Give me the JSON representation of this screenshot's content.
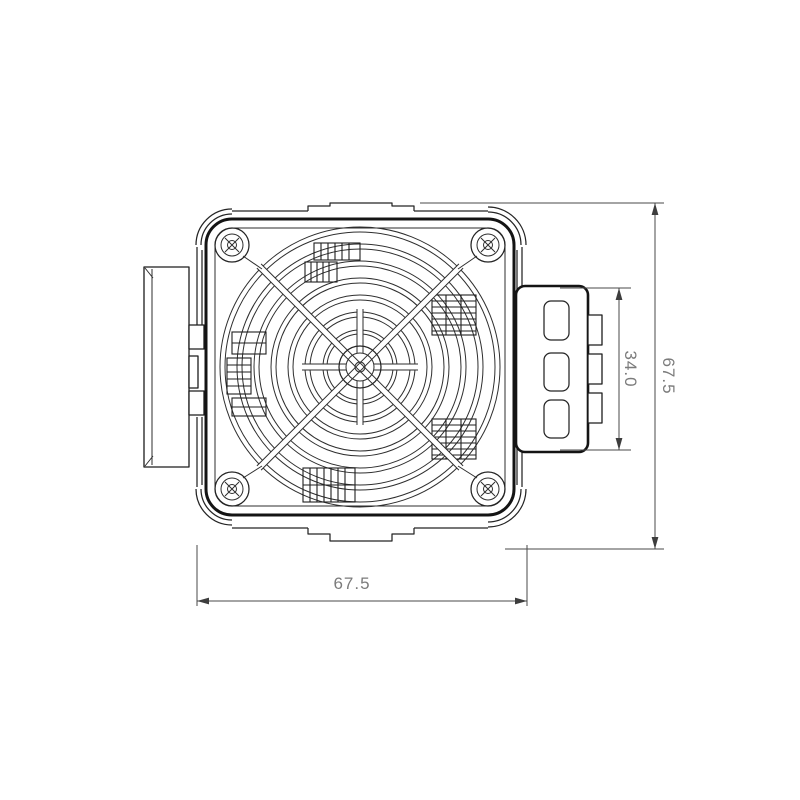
{
  "drawing": {
    "kind": "engineering-line-drawing",
    "subject": "fan-heater-front-view",
    "view": "front",
    "dimension_labels": {
      "bottom_width": "67.5",
      "right_height": "67.5",
      "connector_height": "34.0"
    },
    "features": {
      "corner_screw_count": "4",
      "connector_slot_count": "3",
      "connector_terminal_count": "3"
    },
    "colors": {
      "background": "#ffffff",
      "outline_heavy": "#141414",
      "outline_light": "#242424",
      "dimension_line": "#4a4a4a",
      "dimension_text": "#7b7b7b"
    }
  }
}
